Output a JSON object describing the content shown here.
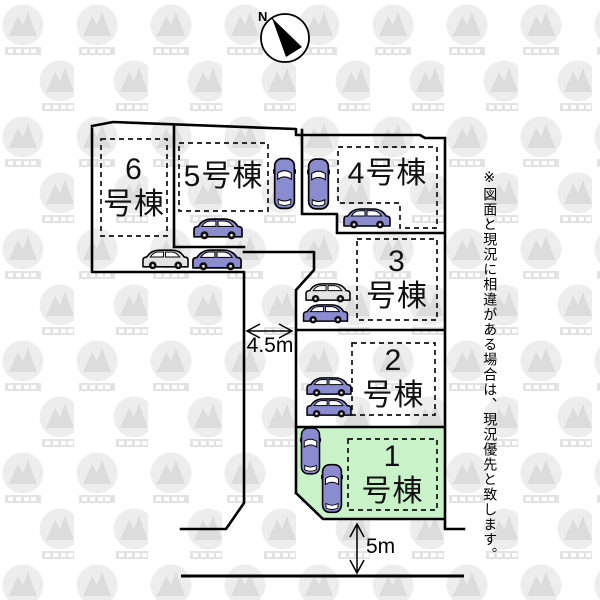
{
  "compass": {
    "north_label": "N"
  },
  "plan": {
    "lots": [
      {
        "name": "6号棟",
        "line1": "6",
        "line2": "号棟"
      },
      {
        "name": "5号棟",
        "line1": "5号棟",
        "line2": ""
      },
      {
        "name": "4号棟",
        "line1": "4号棟",
        "line2": ""
      },
      {
        "name": "3号棟",
        "line1": "3",
        "line2": "号棟"
      },
      {
        "name": "2号棟",
        "line1": "2",
        "line2": "号棟"
      },
      {
        "name": "1号棟",
        "line1": "1",
        "line2": "号棟"
      }
    ],
    "dimensions": [
      {
        "label": "4.5m"
      },
      {
        "label": "5m"
      }
    ],
    "highlight_color": "#c9f2c9",
    "car_color": "#8b8bd0",
    "car_alt_color": "#e3e3e3",
    "line_color": "#000000"
  },
  "disclaimer": "※図面と現況に相違がある場合は、現況優先と致します。"
}
